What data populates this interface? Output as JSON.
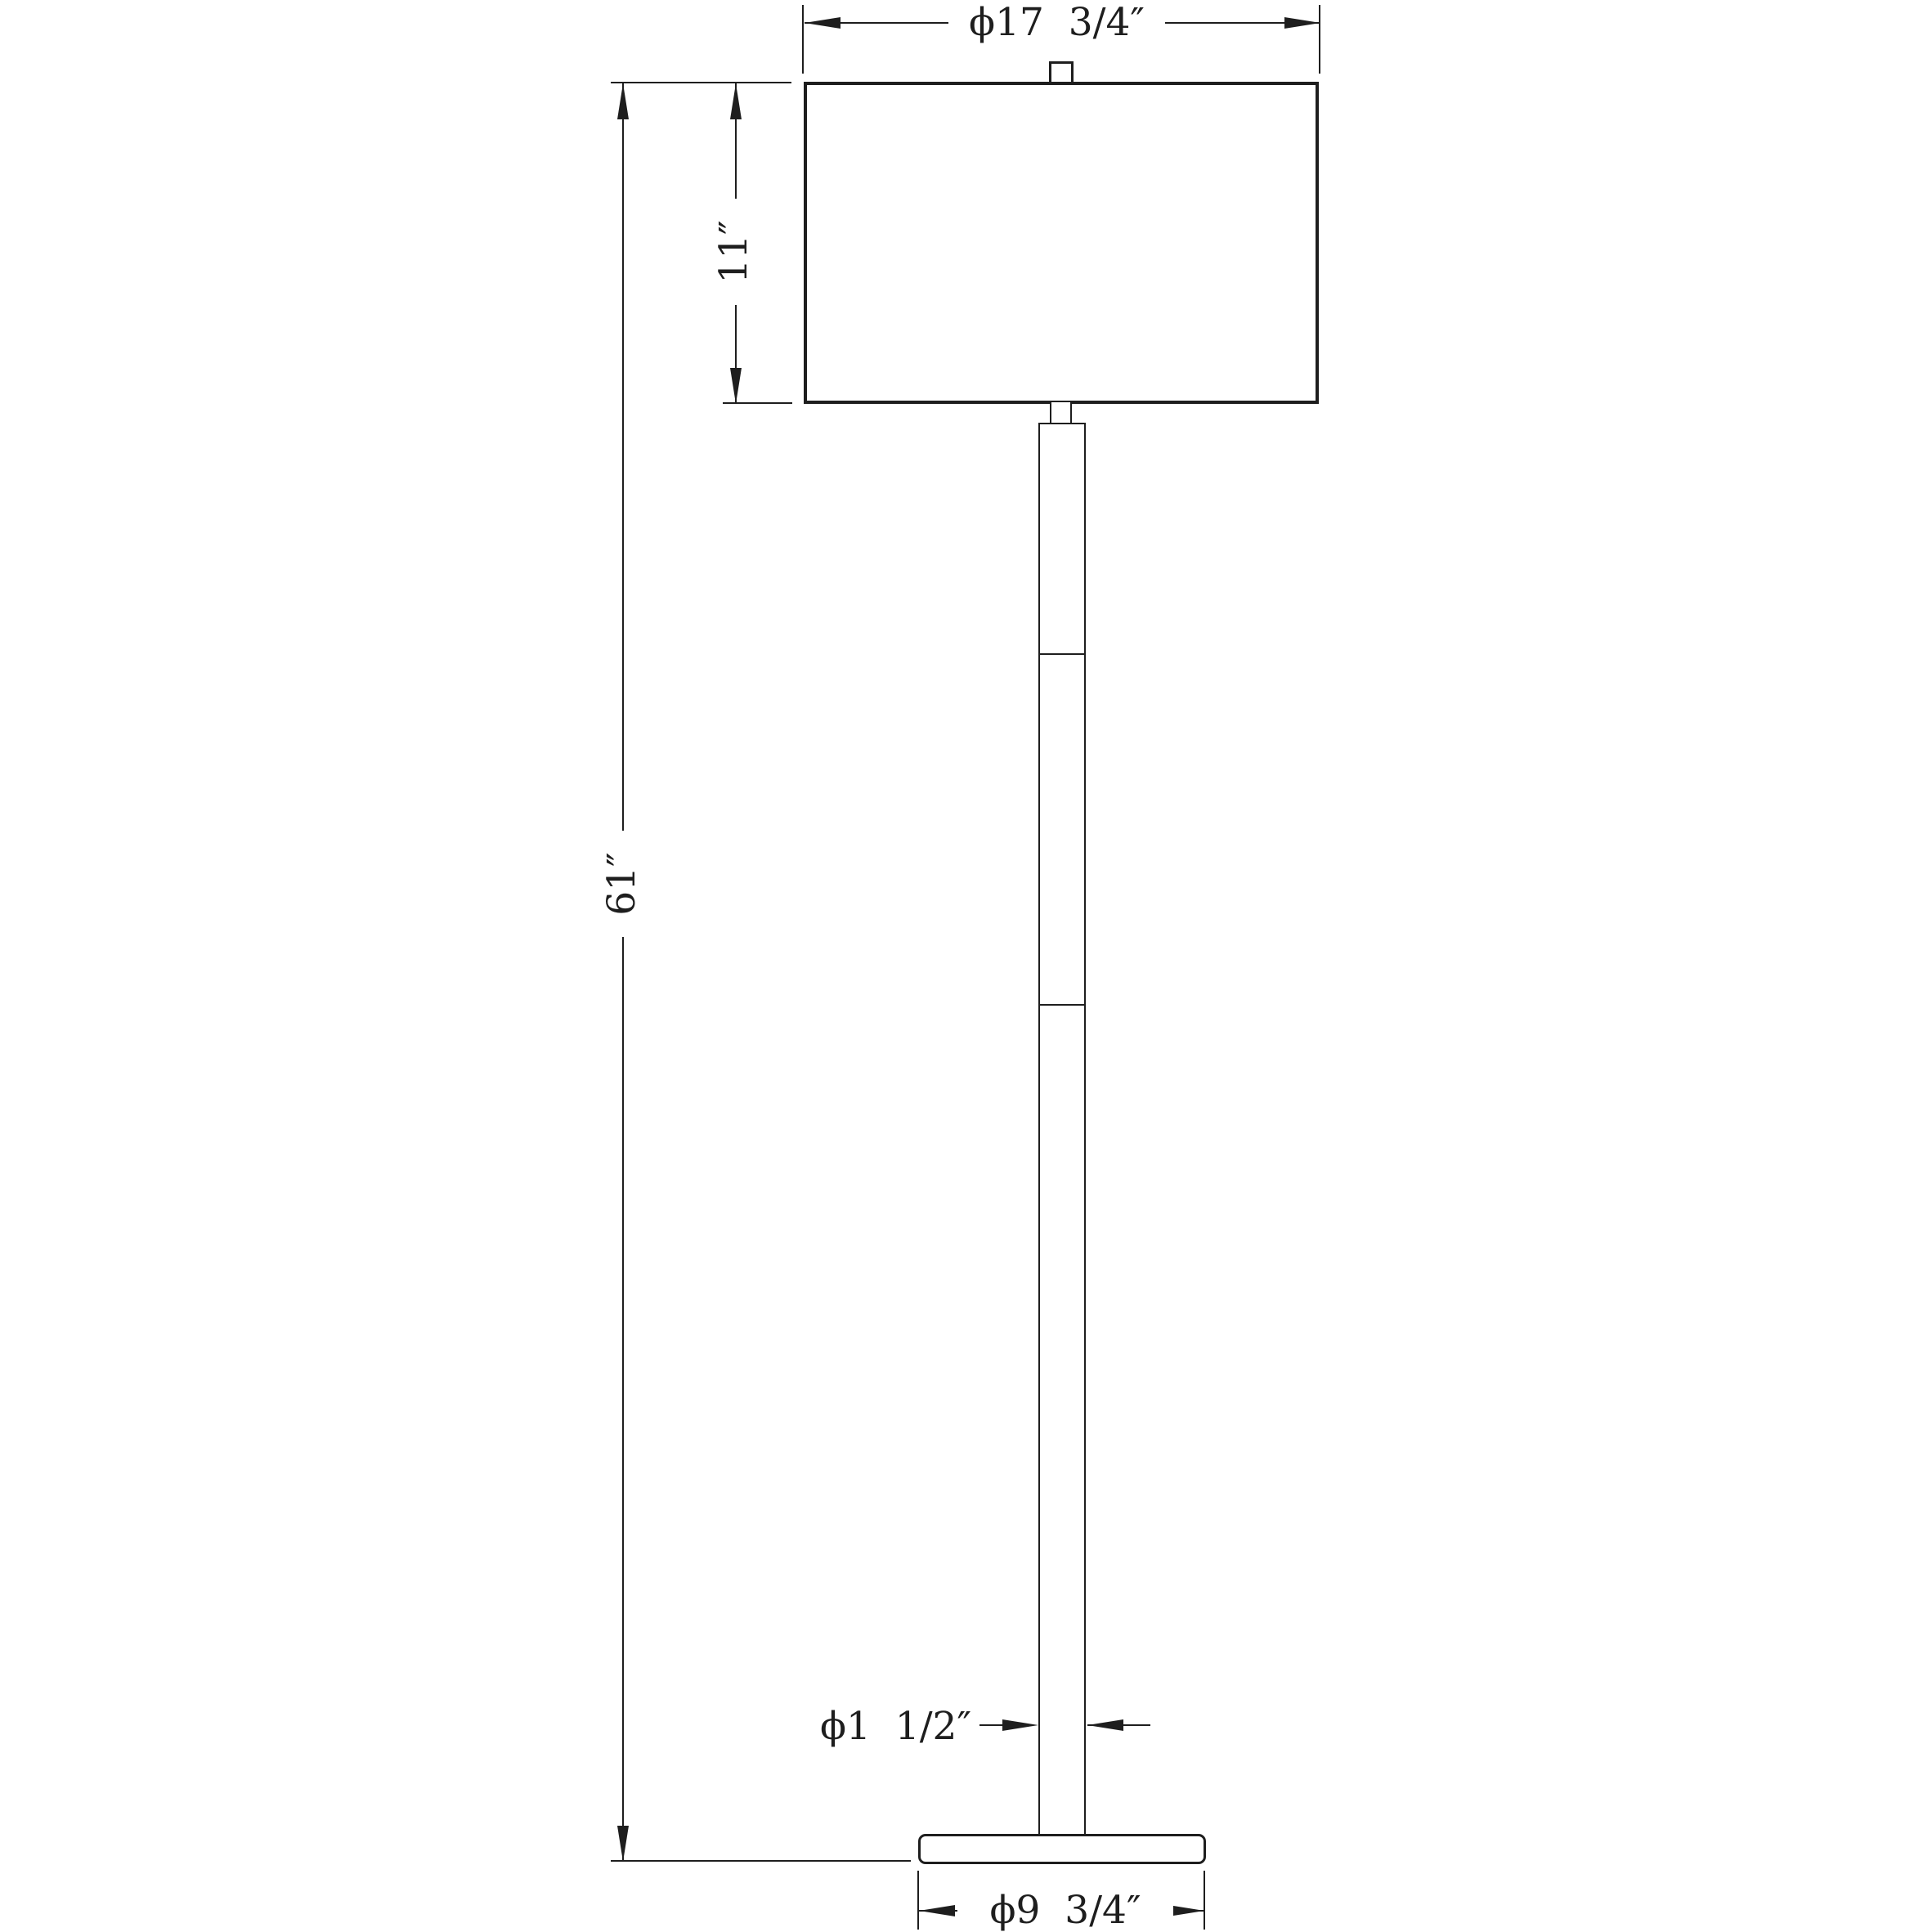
{
  "theme": {
    "background": "#ffffff",
    "ink": "#1e1e1e"
  },
  "drawing": {
    "subject": "floor lamp dimension drawing",
    "dims": {
      "shade_diameter": "ϕ17  3/4″",
      "shade_height": "11″",
      "overall_height": "61″",
      "pole_diameter": "ϕ1  1/2″",
      "base_diameter": "ϕ9  3/4″"
    }
  }
}
